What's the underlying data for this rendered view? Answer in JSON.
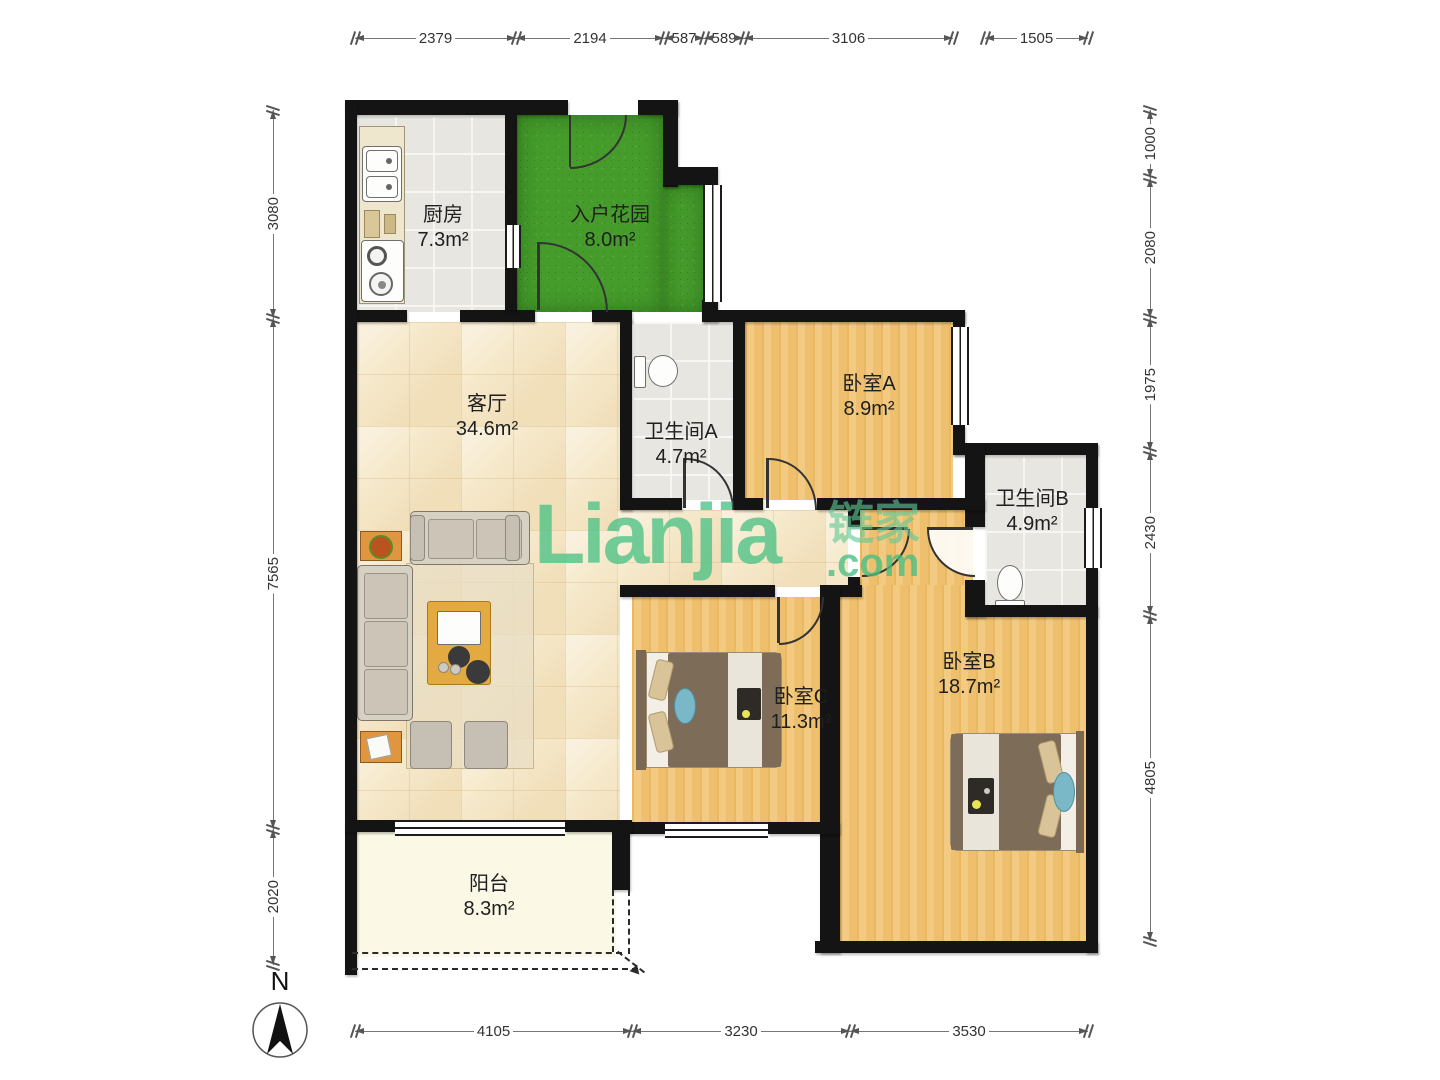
{
  "watermark": {
    "logo": "Lianjia",
    "cjk": "链家",
    "domain": ".com",
    "color": "#4cc185"
  },
  "compass": {
    "label": "N"
  },
  "rooms": {
    "kitchen": {
      "name": "厨房",
      "area": "7.3m²"
    },
    "garden": {
      "name": "入户花园",
      "area": "8.0m²"
    },
    "living": {
      "name": "客厅",
      "area": "34.6m²"
    },
    "bathA": {
      "name": "卫生间A",
      "area": "4.7m²"
    },
    "bedA": {
      "name": "卧室A",
      "area": "8.9m²"
    },
    "bathB": {
      "name": "卫生间B",
      "area": "4.9m²"
    },
    "bedC": {
      "name": "卧室C",
      "area": "11.3m²"
    },
    "bedB": {
      "name": "卧室B",
      "area": "18.7m²"
    },
    "balcony": {
      "name": "阳台",
      "area": "8.3m²"
    }
  },
  "dims": {
    "top": [
      "2379",
      "2194",
      "587",
      "589",
      "3106",
      "1505"
    ],
    "bottom": [
      "4105",
      "3230",
      "3530"
    ],
    "left": [
      "3080",
      "7565",
      "2020"
    ],
    "right": [
      "1000",
      "2080",
      "1975",
      "2430",
      "4805"
    ]
  }
}
